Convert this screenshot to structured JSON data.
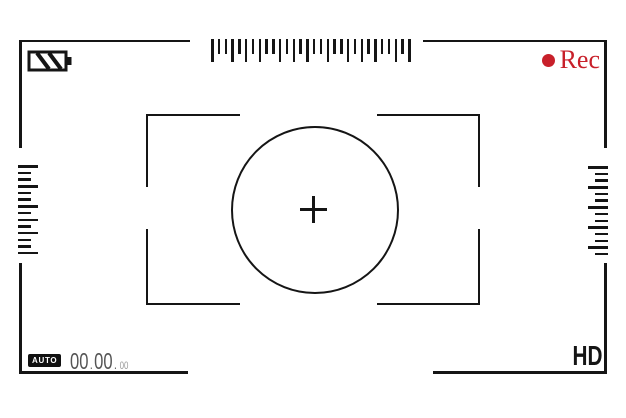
{
  "app": {
    "name": "Camera viewfinder recording screen",
    "background": "#ffffff",
    "line_color": "#151515"
  },
  "top_bar": {
    "battery": {
      "icon": "battery-icon",
      "style": "diagonal-stripes",
      "stripe_count": 2
    },
    "rec_indicator": {
      "dot_icon": "record-dot-icon",
      "label": "Rec",
      "color": "#c8202a"
    }
  },
  "rulers": {
    "top": {
      "orientation": "horizontal",
      "pattern": [
        "l",
        "s",
        "s",
        "l",
        "s",
        "l",
        "s",
        "l",
        "s",
        "s",
        "l",
        "s",
        "l",
        "s",
        "l",
        "s",
        "s",
        "l",
        "s",
        "s",
        "l",
        "s",
        "l",
        "s",
        "l",
        "s",
        "s",
        "l",
        "s",
        "l"
      ]
    },
    "left": {
      "orientation": "vertical",
      "pattern": [
        "l",
        "s",
        "s",
        "l",
        "s",
        "s",
        "l",
        "s",
        "l",
        "s",
        "l",
        "s",
        "s",
        "l"
      ]
    },
    "right": {
      "orientation": "vertical",
      "pattern": [
        "l",
        "s",
        "s",
        "l",
        "s",
        "s",
        "l",
        "s",
        "s",
        "l",
        "s",
        "s",
        "l",
        "s"
      ]
    }
  },
  "focus_area": {
    "circle": "focus-circle",
    "crosshair_icon": "crosshair-icon"
  },
  "bottom_bar": {
    "mode_badge": {
      "label": "AUTO",
      "bg": "#111111",
      "text_color": "#ffffff"
    },
    "timecode": {
      "hours": "00",
      "minutes": "00",
      "seconds": "00",
      "separator": "."
    },
    "quality_label": "HD"
  }
}
